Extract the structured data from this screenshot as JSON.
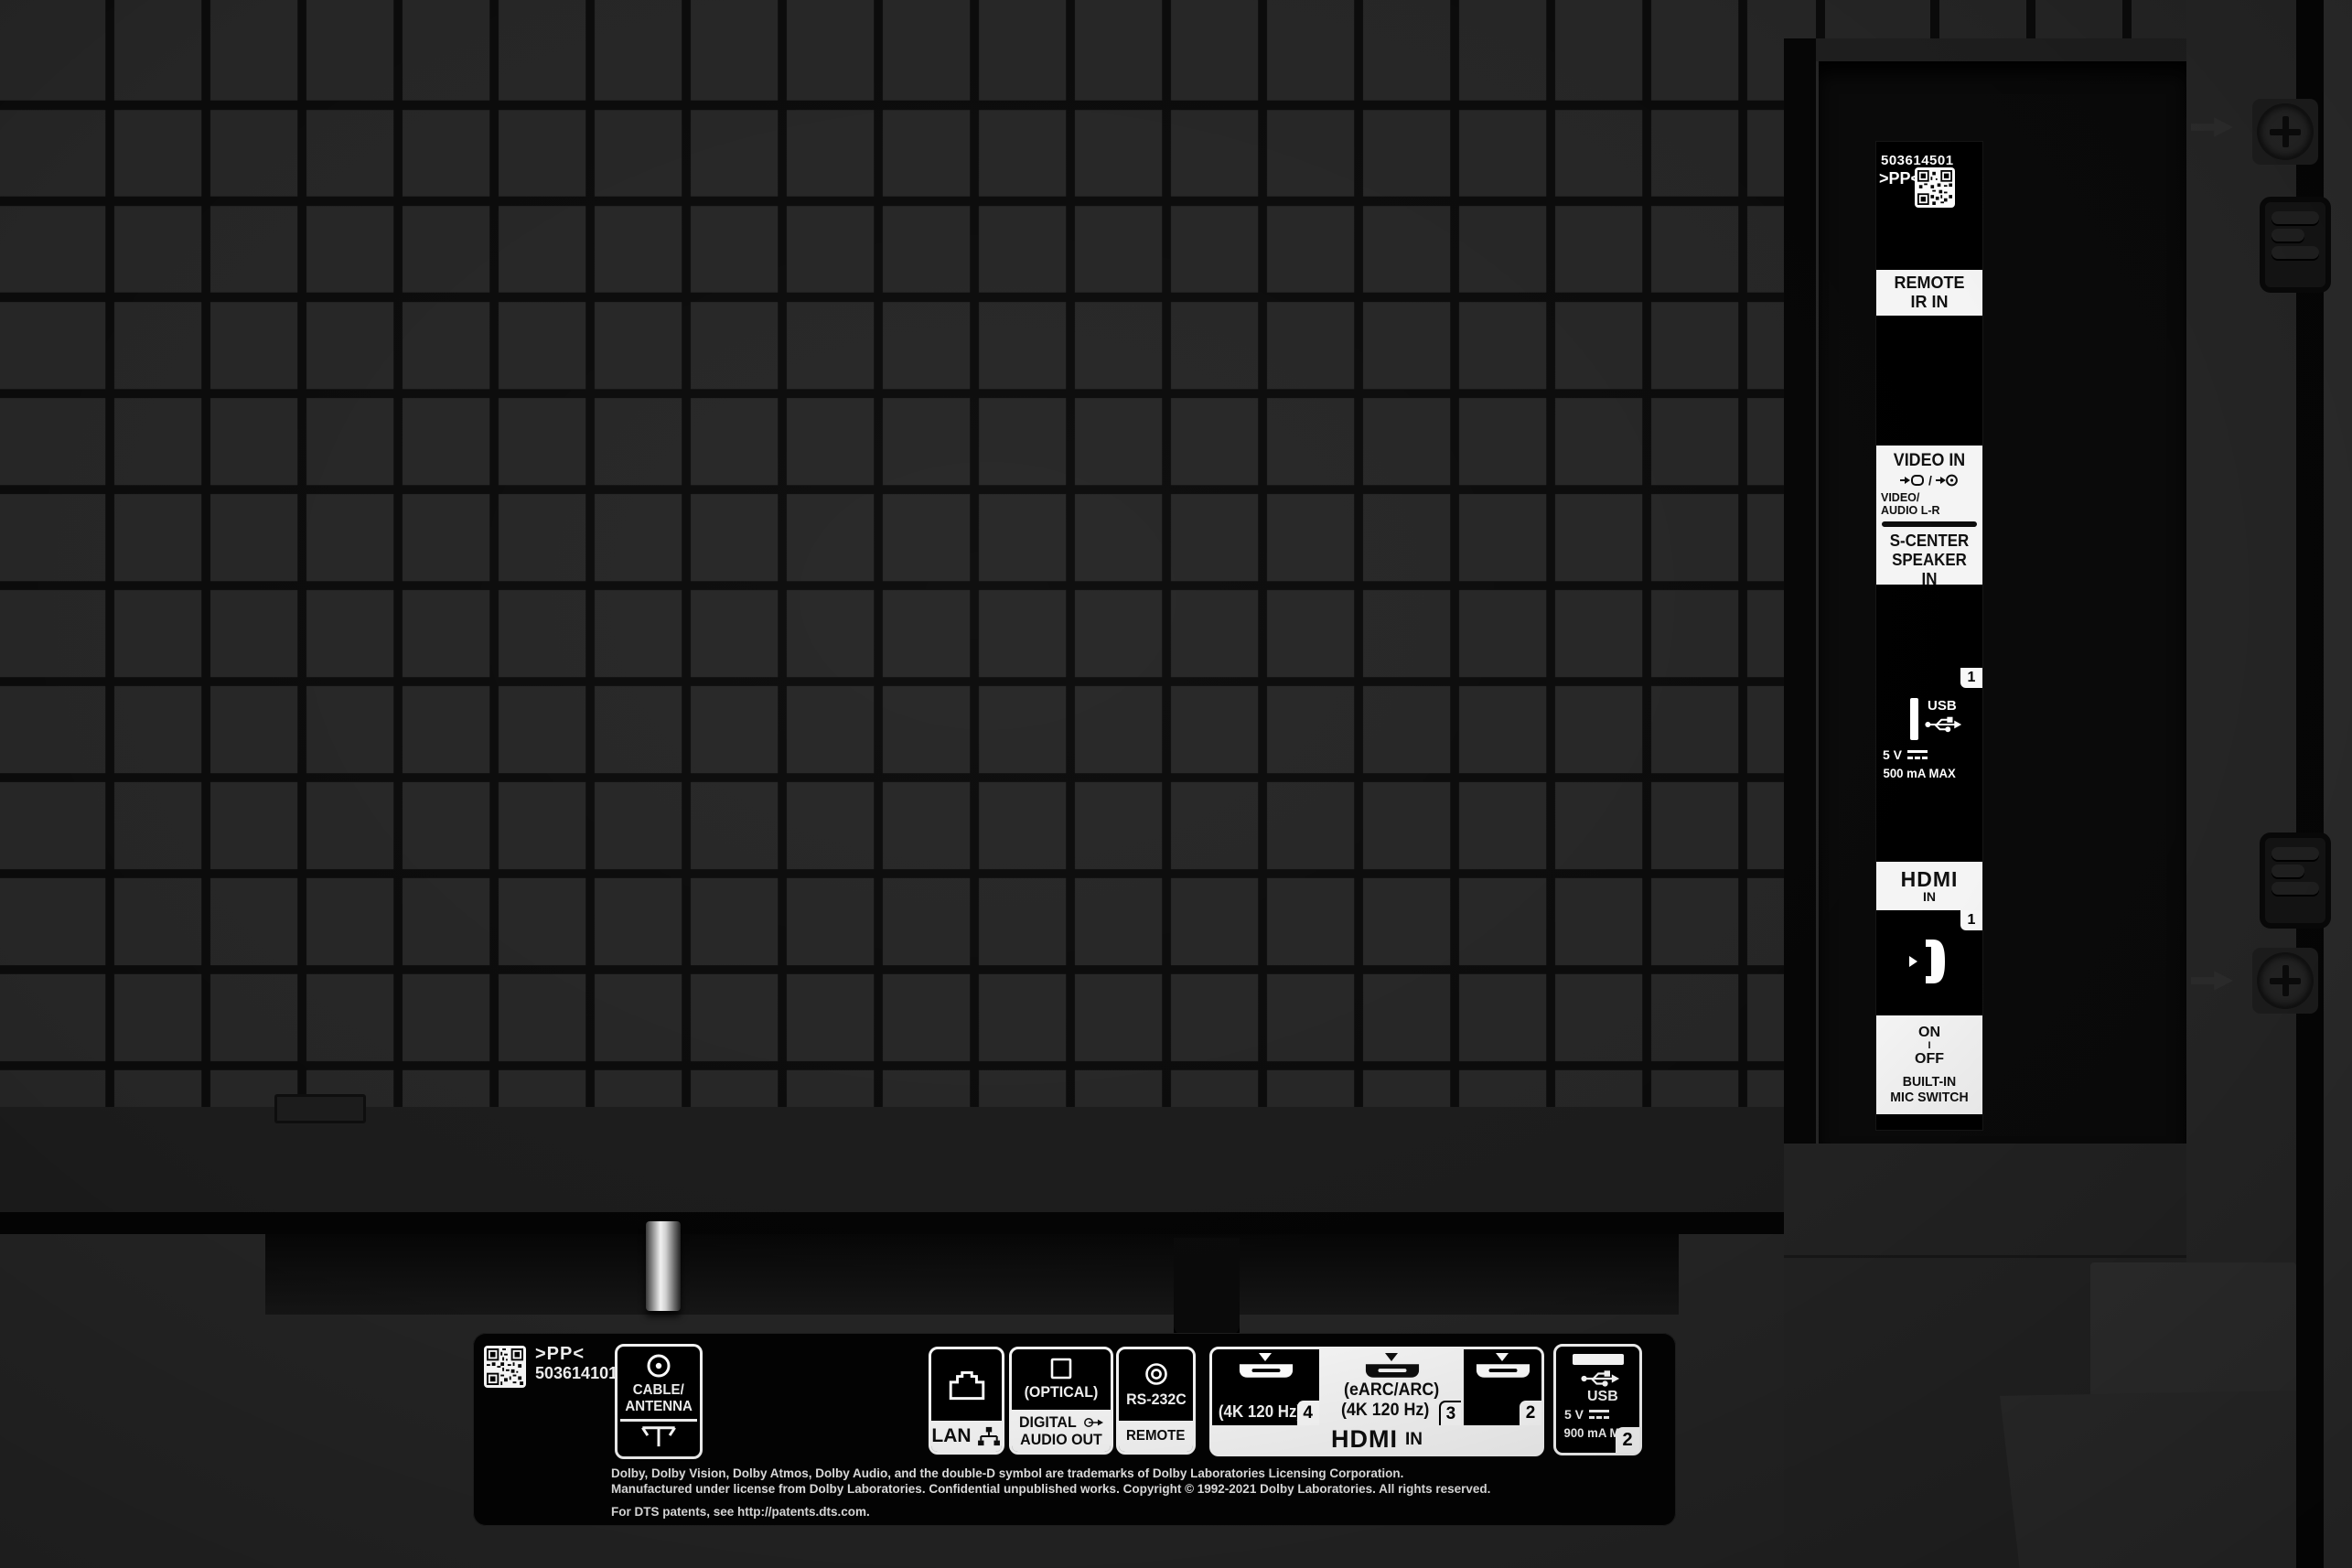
{
  "colors": {
    "body_gray": "#232323",
    "panel_black": "#000000",
    "label_white": "#f4f4f4",
    "tile_gray": "#262626"
  },
  "side_strip": {
    "serial": "503614501",
    "pp": ">PP<",
    "remote_ir": {
      "l1": "REMOTE",
      "l2": "IR IN"
    },
    "video": {
      "title": "VIDEO IN",
      "sep": "/",
      "sub1": "VIDEO/",
      "sub2": "AUDIO L-R",
      "sc1": "S-CENTER",
      "sc2": "SPEAKER IN"
    },
    "usb": {
      "num": "1",
      "label": "USB",
      "volt": "5 V",
      "amp": "500 mA MAX"
    },
    "hdmi": {
      "word": "HDMI",
      "in_txt": "IN",
      "num": "1"
    },
    "mic": {
      "on": "ON",
      "mid": "I",
      "off": "OFF",
      "l1": "BUILT-IN",
      "l2": "MIC SWITCH"
    }
  },
  "bottom": {
    "pp": ">PP<",
    "serial": "503614101",
    "cable": {
      "l1": "CABLE/",
      "l2": "ANTENNA"
    },
    "lan": {
      "label": "LAN"
    },
    "optical": {
      "top": "(OPTICAL)",
      "l1": "DIGITAL",
      "l2": "AUDIO OUT"
    },
    "rs232c": {
      "top": "RS-232C",
      "band": "REMOTE"
    },
    "hdmi": {
      "p4": {
        "speed": "(4K 120 Hz)",
        "num": "4"
      },
      "p3": {
        "earc": "(eARC/ARC)",
        "speed": "(4K 120 Hz)",
        "num": "3"
      },
      "p2": {
        "num": "2"
      },
      "word": "HDMI",
      "in_txt": "IN"
    },
    "usb": {
      "label": "USB",
      "volt": "5 V",
      "amp": "900 mA MAX",
      "num": "2"
    },
    "legal": {
      "l1": "Dolby, Dolby Vision, Dolby Atmos, Dolby Audio, and the double-D symbol are trademarks of Dolby Laboratories Licensing Corporation.",
      "l2": "Manufactured under license from Dolby Laboratories. Confidential unpublished works. Copyright © 1992-2021 Dolby Laboratories. All rights reserved.",
      "l3": "For DTS patents, see http://patents.dts.com."
    }
  }
}
